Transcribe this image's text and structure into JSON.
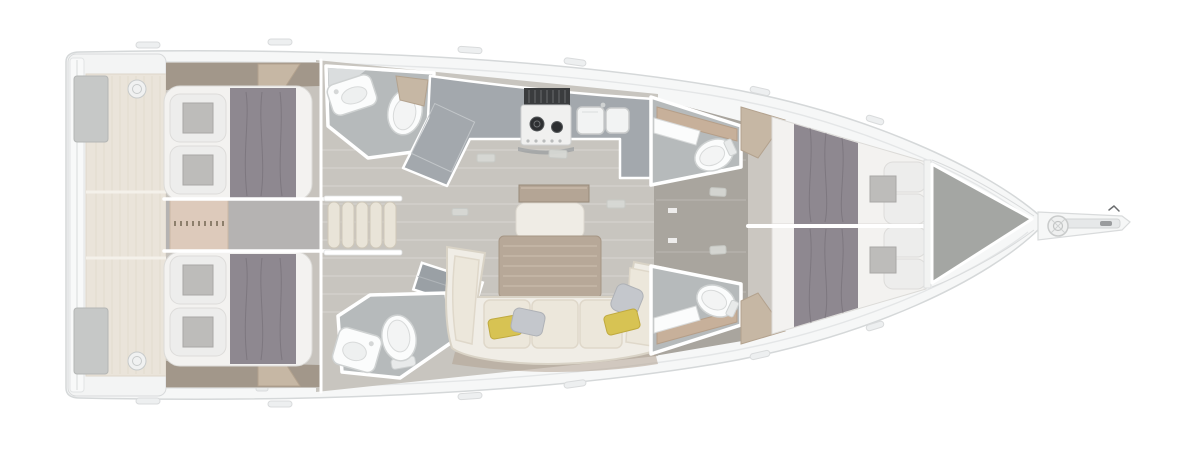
{
  "title": "Sailboat interior deck layout plan, top-down view, bow pointing right",
  "canvas": {
    "width": 1200,
    "height": 451,
    "background": "#ffffff"
  },
  "palette": {
    "hull": "#f6f7f7",
    "hullStroke": "#d5d8d9",
    "deckSeam": "#e4e6e7",
    "floor": "#c8c5bf",
    "floorLight": "#d7d3cc",
    "corridor": "#a9a59e",
    "corridorGray": "#b5b3b2",
    "wallTaupe": "#a2978a",
    "woodTan": "#c6b7a4",
    "transomBeige": "#eae4da",
    "lockerGray": "#c6c8c7",
    "mattress": "#f3f2f0",
    "duvet": "#8e8890",
    "pillowShell": "#ededec",
    "pillowPad": "#bdbcba",
    "bathFloor": "#b6babb",
    "fixture": "#fbfcfc",
    "galley": "#a3a8ad",
    "hood": "#3a3c3e",
    "stove": "#f0f0ef",
    "burner": "#2d2f31",
    "sofa": "#ece7db",
    "sofaShell": "#f0ede6",
    "sofaShadow": "#b2a291",
    "table": "#b7a898",
    "cabinetTan": "#ddcabb",
    "pillowYellow": "#d7c353",
    "pillowSilver": "#c4c7cc",
    "forepeak": "#a4a6a3",
    "trim": "#ffffff"
  },
  "rooms": [
    {
      "id": "transom-platform",
      "description": "Stern swim platform with twin cockpit lockers"
    },
    {
      "id": "aft-cabin-port",
      "description": "Aft double cabin, port side"
    },
    {
      "id": "aft-cabin-starboard",
      "description": "Aft double cabin, starboard side"
    },
    {
      "id": "aft-head-port",
      "description": "Aft head with washbasin and toilet, port"
    },
    {
      "id": "aft-head-starboard",
      "description": "Aft head with washbasin and toilet, starboard"
    },
    {
      "id": "chair-stowage",
      "description": "Five stowed folding chairs amidships"
    },
    {
      "id": "companionway",
      "description": "Companionway landing beside the galley"
    },
    {
      "id": "galley",
      "description": "L-shaped galley with two-burner stove and twin sinks"
    },
    {
      "id": "salon",
      "description": "Salon with C-shaped settee, table and scatter cushions"
    },
    {
      "id": "fwd-head-port",
      "description": "Forward head, port"
    },
    {
      "id": "fwd-head-starboard",
      "description": "Forward head, starboard"
    },
    {
      "id": "fwd-cabin-port",
      "description": "Forward double cabin, port"
    },
    {
      "id": "fwd-cabin-starboard",
      "description": "Forward double cabin, starboard"
    },
    {
      "id": "forepeak",
      "description": "Forepeak sail locker"
    },
    {
      "id": "bow",
      "description": "Bow with windlass and bowsprit anchor roller"
    }
  ],
  "equipment": {
    "stove_burners": 2,
    "galley_sinks": 2,
    "cabins": 4,
    "heads": 4,
    "berths": 4,
    "folding_chairs": 5
  }
}
